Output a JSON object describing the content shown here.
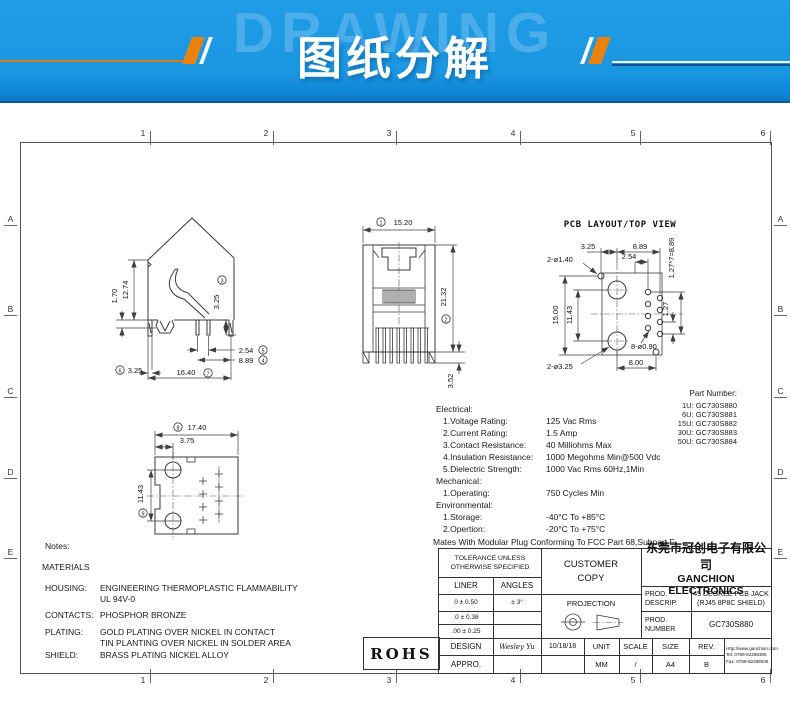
{
  "banner": {
    "watermark": "DRAWING",
    "title": "图纸分解"
  },
  "colors": {
    "banner_blue": "#1b97e2",
    "banner_orange": "#e8820c",
    "line_color": "#3a3a3a"
  },
  "frame": {
    "cols": [
      "1",
      "2",
      "3",
      "4",
      "5",
      "6"
    ],
    "rows": [
      "A",
      "B",
      "C",
      "D",
      "E"
    ]
  },
  "side_view": {
    "dim_1_70": "1.70",
    "dim_12_74": "12.74",
    "dim_3_25_pin": "3.25",
    "ref_3": "3",
    "dim_2_54": "2.54",
    "ref_5": "5",
    "dim_8_89": "8.89",
    "ref_4": "4",
    "ref_6": "6",
    "dim_3_25_left": "3.25",
    "dim_16_40": "16.40",
    "ref_7": "7"
  },
  "front_view": {
    "ref_1": "1",
    "dim_15_20": "15.20",
    "ref_2": "2",
    "dim_21_32": "21.32",
    "dim_3_52": "3.52"
  },
  "pcb_view": {
    "title": "PCB LAYOUT/TOP VIEW",
    "dim_3_25": "3.25",
    "dim_8_89": "8.89",
    "dim_2_54": "2.54",
    "holes_1_40": "2-ø1.40",
    "pitch": "1.27*7=8.89",
    "dim_15_00": "15.00",
    "dim_11_43": "11.43",
    "dim_1_27": "1.27",
    "holes_0_90": "8-ø0.90",
    "holes_3_25": "2-ø3.25",
    "dim_8_00": "8.00"
  },
  "bottom_view": {
    "ref_8": "8",
    "dim_17_40": "17.40",
    "dim_3_75": "3.75",
    "ref_9": "9",
    "dim_11_43": "11.43"
  },
  "part_numbers": {
    "title": "Part Number:",
    "items": [
      "1U: GC730S880",
      "6U: GC730S881",
      "15U: GC730S882",
      "30U: GC730S883",
      "50U: GC730S884"
    ]
  },
  "specs": {
    "electrical_title": "Electrical:",
    "rows_e": [
      [
        "1.Voltage Rating:",
        "125 Vac Rms"
      ],
      [
        "2.Current Rating:",
        "1.5 Amp"
      ],
      [
        "3.Contact Resistance:",
        "40 Milliohms Max"
      ],
      [
        "4.Insulation Resistance:",
        "1000 Megohms Min@500 Vdc"
      ],
      [
        "5.Dielectric Strength:",
        "1000 Vac Rms 60Hz,1Min"
      ]
    ],
    "mechanical_title": "Mechanical:",
    "rows_m": [
      [
        "1.Operating:",
        "750 Cycles Min"
      ]
    ],
    "environmental_title": "Environmental:",
    "rows_v": [
      [
        "1.Storage:",
        "-40°C To +85°C"
      ],
      [
        "2.Opertion:",
        "-20°C To +75°C"
      ]
    ],
    "mates_note": "Mates With Modular Plug Conforming To FCC Part 68,Subpart F"
  },
  "notes": {
    "title": "Notes:",
    "materials": "MATERIALS",
    "housing_label": "HOUSING:",
    "housing_value1": "ENGINEERING THERMOPLASTIC FLAMMABILITY",
    "housing_value2": "UL 94V-0",
    "contacts_label": "CONTACTS:",
    "contacts_value": "PHOSPHOR BRONZE",
    "plating_label": "PLATING:",
    "plating_value1": "GOLD PLATING OVER NICKEL IN CONTACT",
    "plating_value2": "TIN PLANTING OVER NICKEL IN SOLDER AREA",
    "shield_label": "SHIELD:",
    "shield_value": "BRASS PLATING NICKEL ALLOY"
  },
  "title_block": {
    "tolerance_header": "TOLERANCE UNLESS\nOTHERWISE SPECIFIED",
    "liner": "LINER",
    "angles": "ANGLES",
    "tol1_liner": "0  ±  0.50",
    "tol1_angles": "±  3°",
    "tol2_liner": ".0  ±  0.38",
    "tol3_liner": ".00 ±  0.25",
    "design_label": "DESIGN",
    "design_name": "Wesley Yu",
    "design_date": "10/18/18",
    "appro_label": "APPRO.",
    "customer_copy": "CUSTOMER\nCOPY",
    "projection_label": "PROJECTION",
    "company_cn": "东莞市冠创电子有限公司",
    "company_en": "GANCHION ELECTRONICS",
    "prod_descrip_label": "PROD.\nDESCRIP.",
    "prod_descrip_value": "45 DEGREE PCB JACK\n(RJ45 8P8C SHIELD)",
    "prod_number_label": "PROD.\nNUMBER",
    "prod_number_value": "GC730S880",
    "unit_label": "UNIT",
    "unit_value": "MM",
    "scale_label": "SCALE",
    "scale_value": "/",
    "size_label": "SIZE",
    "size_value": "A4",
    "rev_label": "REV.",
    "rev_value": "B",
    "website": "Http://www.ganchion.com",
    "tel": "Tel:  0769-82288306",
    "fax": "Fax: 0769-82288536",
    "rohs": "ROHS"
  }
}
